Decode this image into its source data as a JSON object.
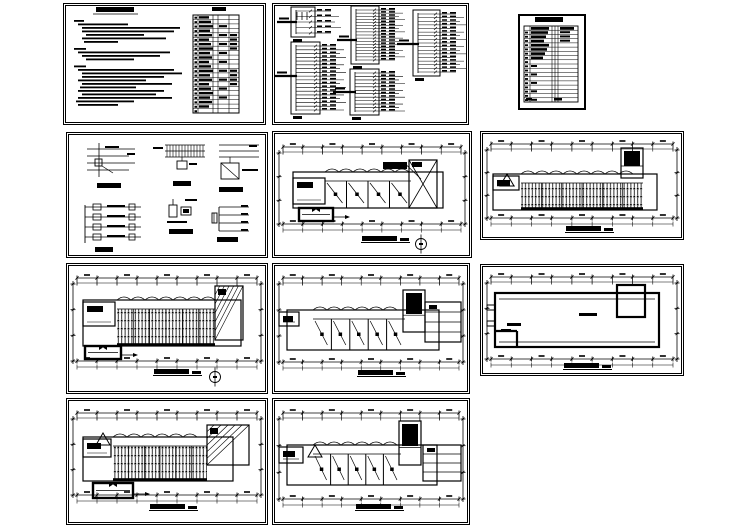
{
  "canvas": {
    "width": 749,
    "height": 530,
    "background": "#ffffff",
    "ink": "#000000"
  },
  "sheets": [
    {
      "id": "notes",
      "kind": "notes",
      "title": "电气设计说明",
      "legend_title": "图例"
    },
    {
      "id": "systems",
      "kind": "systems",
      "boxes": [
        {
          "label": "AL1"
        },
        {
          "label": "AL2"
        },
        {
          "label": "AL3"
        },
        {
          "label": "AL4"
        },
        {
          "label": "AL5"
        }
      ]
    },
    {
      "id": "index",
      "kind": "index",
      "title": "图纸目录"
    },
    {
      "id": "details",
      "kind": "details",
      "captions": [
        "应急照明接线图",
        "弱电系统图",
        "防雷引下线大样",
        "干线系统图",
        "等电位联结大样",
        "接地装置大样"
      ]
    },
    {
      "id": "plan1",
      "kind": "plan",
      "title": "一层电气平面图",
      "scale": "1:100"
    },
    {
      "id": "plan2",
      "kind": "plan",
      "title": "二层照明平面图",
      "scale": "1:100"
    },
    {
      "id": "plan3",
      "kind": "plan",
      "title": "一层照明平面图",
      "scale": "1:100"
    },
    {
      "id": "plan4",
      "kind": "plan",
      "title": "二层电气平面图",
      "scale": "1:100"
    },
    {
      "id": "plan5",
      "kind": "plan",
      "title": "屋顶防雷平面图",
      "scale": "1:100"
    },
    {
      "id": "plan6",
      "kind": "plan",
      "title": "三层照明平面图",
      "scale": "1:100"
    },
    {
      "id": "plan7",
      "kind": "plan",
      "title": "三层电气平面图",
      "scale": "1:100"
    }
  ]
}
